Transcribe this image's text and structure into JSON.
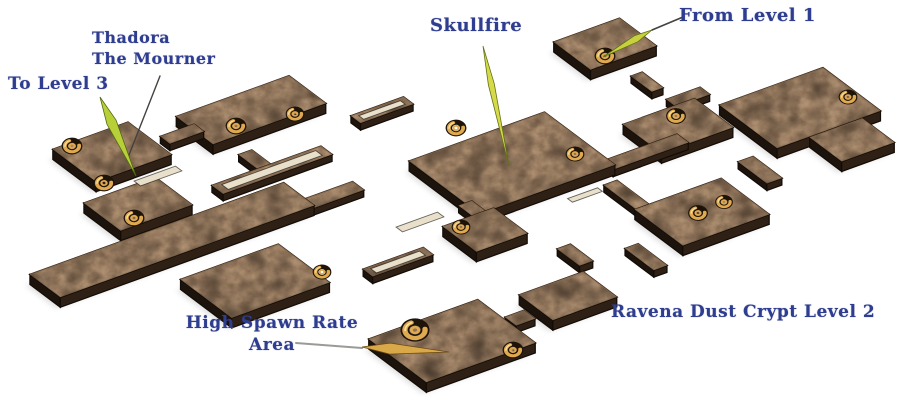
{
  "scene": {
    "background": "#ffffff",
    "description": "Isometric dungeon map of cracked brown stone platforms connected by corridors, gold spiral stair markers, navy blackletter labels with yellow-green pointer arrows"
  },
  "labels": {
    "to_level_3": {
      "text": "To Level 3"
    },
    "thadora": {
      "line1": "Thadora",
      "line2": "The Mourner"
    },
    "skullfire": {
      "text": "Skullfire"
    },
    "from_level_1": {
      "text": "From Level 1"
    },
    "high_spawn": {
      "line1": "High Spawn Rate",
      "line2": "Area"
    },
    "crypt_title": {
      "text": "Ravena Dust Crypt Level 2"
    }
  },
  "colors": {
    "background": "#ffffff",
    "label_text": "#2e3d8f",
    "platform_top": "#5a4230",
    "platform_side_left": "#1c130c",
    "platform_side_right": "#32231634",
    "platform_side_right_solid": "#2e2014",
    "outline": "#120b06",
    "edge_highlight": "#9a7450",
    "slot_light": "#e9e0cc",
    "stairs_gold": "#dfa94f",
    "stairs_gold_highlight": "#f7e2a4",
    "stairs_ring_dark": "#1d1309",
    "arrow_yellow_green": "#c9d03f",
    "arrow_green_edge": "#5f7316",
    "arrow_gold": "#d9a848",
    "arrow_gold_edge": "#6b4a10",
    "pointer_line_dark": "#44423e",
    "pointer_line_silver": "#9a9a96",
    "shadow": "#6b6b6b"
  },
  "map": {
    "stairs_icon": "spiral-stairs-icon",
    "rooms": [
      {
        "name": "entry-from-level-1",
        "x": 605,
        "y": 44,
        "a": 35,
        "b": 23
      },
      {
        "name": "northeast-hall",
        "x": 800,
        "y": 108,
        "a": 55,
        "b": 36
      },
      {
        "name": "far-east-room",
        "x": 852,
        "y": 140,
        "a": 28,
        "b": 20
      },
      {
        "name": "east-mid-room",
        "x": 678,
        "y": 126,
        "a": 38,
        "b": 24
      },
      {
        "name": "east-lower-room",
        "x": 702,
        "y": 212,
        "a": 46,
        "b": 30
      },
      {
        "name": "skullfire-hall",
        "x": 512,
        "y": 163,
        "a": 72,
        "b": 44
      },
      {
        "name": "north-center-room",
        "x": 251,
        "y": 110,
        "a": 60,
        "b": 23
      },
      {
        "name": "to-level-3-room",
        "x": 112,
        "y": 152,
        "a": 40,
        "b": 27
      },
      {
        "name": "thadora-room",
        "x": 138,
        "y": 204,
        "a": 38,
        "b": 23
      },
      {
        "name": "west-walkway",
        "x": 172,
        "y": 240,
        "a": 135,
        "b": 19
      },
      {
        "name": "cross-platform",
        "x": 255,
        "y": 281,
        "a": 52,
        "b": 32
      },
      {
        "name": "mid-south-room",
        "x": 485,
        "y": 230,
        "a": 27,
        "b": 21
      },
      {
        "name": "south-east-room",
        "x": 568,
        "y": 296,
        "a": 34,
        "b": 21
      },
      {
        "name": "high-spawn-room",
        "x": 452,
        "y": 341,
        "a": 58,
        "b": 36
      }
    ],
    "corridors": [
      {
        "name": "c-entry-down",
        "x": 647,
        "y": 82,
        "a": 6,
        "b": 13
      },
      {
        "name": "c-entry-east",
        "x": 688,
        "y": 97,
        "a": 18,
        "b": 6
      },
      {
        "name": "c-east-link",
        "x": 645,
        "y": 152,
        "a": 40,
        "b": 7
      },
      {
        "name": "c-north-link",
        "x": 382,
        "y": 110,
        "a": 28,
        "b": 6
      },
      {
        "name": "c-west-link",
        "x": 182,
        "y": 134,
        "a": 18,
        "b": 6
      },
      {
        "name": "c-skull-to-east",
        "x": 628,
        "y": 196,
        "a": 7,
        "b": 22
      },
      {
        "name": "c-skull-south",
        "x": 478,
        "y": 213,
        "a": 7,
        "b": 16
      },
      {
        "name": "c-cross-east",
        "x": 398,
        "y": 262,
        "a": 32,
        "b": 6
      },
      {
        "name": "c-spawn-link",
        "x": 520,
        "y": 318,
        "a": 10,
        "b": 7
      },
      {
        "name": "c-east-south",
        "x": 646,
        "y": 257,
        "a": 7,
        "b": 18
      },
      {
        "name": "c-center-row",
        "x": 272,
        "y": 170,
        "a": 58,
        "b": 7
      },
      {
        "name": "c-center-drop",
        "x": 258,
        "y": 162,
        "a": 7,
        "b": 16
      },
      {
        "name": "c-northeast-drop",
        "x": 760,
        "y": 170,
        "a": 8,
        "b": 18
      },
      {
        "name": "c-walkway-link",
        "x": 330,
        "y": 196,
        "a": 30,
        "b": 7
      },
      {
        "name": "c-south-drop",
        "x": 575,
        "y": 255,
        "a": 7,
        "b": 14
      }
    ],
    "slots": [
      {
        "x": 158,
        "y": 176,
        "a": 22,
        "b": 4
      },
      {
        "x": 420,
        "y": 222,
        "a": 22,
        "b": 4
      },
      {
        "x": 585,
        "y": 195,
        "a": 16,
        "b": 3
      },
      {
        "x": 382,
        "y": 110,
        "a": 22,
        "b": 3
      },
      {
        "x": 398,
        "y": 262,
        "a": 26,
        "b": 3.5
      },
      {
        "x": 272,
        "y": 170,
        "a": 50,
        "b": 4
      }
    ],
    "stairs": [
      {
        "x": 605,
        "y": 56,
        "s": 1.0
      },
      {
        "x": 848,
        "y": 97,
        "s": 0.9
      },
      {
        "x": 676,
        "y": 116,
        "s": 0.95
      },
      {
        "x": 698,
        "y": 213,
        "s": 0.95
      },
      {
        "x": 724,
        "y": 202,
        "s": 0.85
      },
      {
        "x": 456,
        "y": 128,
        "s": 1.0
      },
      {
        "x": 575,
        "y": 154,
        "s": 0.9
      },
      {
        "x": 236,
        "y": 126,
        "s": 1.0
      },
      {
        "x": 295,
        "y": 114,
        "s": 0.9
      },
      {
        "x": 72,
        "y": 146,
        "s": 1.0
      },
      {
        "x": 104,
        "y": 183,
        "s": 1.0
      },
      {
        "x": 134,
        "y": 218,
        "s": 1.0
      },
      {
        "x": 322,
        "y": 272,
        "s": 0.9
      },
      {
        "x": 461,
        "y": 227,
        "s": 0.9
      },
      {
        "x": 415,
        "y": 330,
        "s": 1.4
      },
      {
        "x": 513,
        "y": 350,
        "s": 1.0
      }
    ],
    "pointers": {
      "lines": [
        {
          "name": "from-level-1-line",
          "pts": [
            [
              683,
              17
            ],
            [
              652,
              30
            ]
          ],
          "color": "#44423e",
          "w": 1.6
        },
        {
          "name": "thadora-line",
          "pts": [
            [
              160,
              76
            ],
            [
              127,
              160
            ]
          ],
          "color": "#44423e",
          "w": 1.4
        },
        {
          "name": "high-spawn-line",
          "pts": [
            [
              296,
              343
            ],
            [
              362,
              348
            ]
          ],
          "color": "#9a9a96",
          "w": 2
        }
      ],
      "arrows": [
        {
          "name": "from-level-1-arrow",
          "from": [
            652,
            30
          ],
          "to": [
            603,
            57
          ],
          "w": 7,
          "fill": "#c9d03f",
          "edge": "#5f7316"
        },
        {
          "name": "skullfire-arrow",
          "from": [
            483,
            46
          ],
          "to": [
            509,
            166
          ],
          "w": 6,
          "fill": "#d6d94a",
          "edge": "#5f7316"
        },
        {
          "name": "to-level-3-arrow",
          "from": [
            100,
            97
          ],
          "to": [
            136,
            176
          ],
          "w": 10,
          "fill": "#b9cf3a",
          "edge": "#4f6a10"
        },
        {
          "name": "high-spawn-arrow",
          "from": [
            362,
            347
          ],
          "to": [
            449,
            352
          ],
          "w": 11,
          "fill": "#d9a848",
          "edge": "#6b4a10"
        }
      ]
    }
  }
}
